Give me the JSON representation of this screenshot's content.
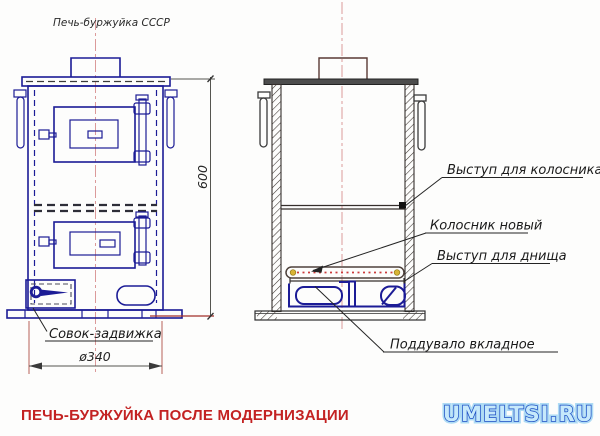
{
  "page": {
    "title_label": "Печь-буржуйка СССР",
    "caption": "ПЕЧЬ-БУРЖУЙКА ПОСЛЕ МОДЕРНИЗАЦИИ",
    "watermark": "UMELTSI.RU"
  },
  "dimensions": {
    "height_mm": "600",
    "diameter_mm": "ø340"
  },
  "annotations": {
    "scoop_damper": "Совок-задвижка",
    "grate_ledge": "Выступ для колосника",
    "new_grate": "Колосник новый",
    "bottom_ledge": "Выступ для днища",
    "ash_pit_insert": "Поддувало вкладное"
  },
  "colors": {
    "front_view_ink": "#1c1c96",
    "section_ink": "#352f2c",
    "centerline": "#d89090",
    "caption_red": "#c32222",
    "watermark_fill": "#c6e9fb",
    "watermark_outline": "#1d4fc4",
    "grate_dotted_red": "#cc3b3b",
    "grate_end_dot_yellow": "#d8b435"
  }
}
